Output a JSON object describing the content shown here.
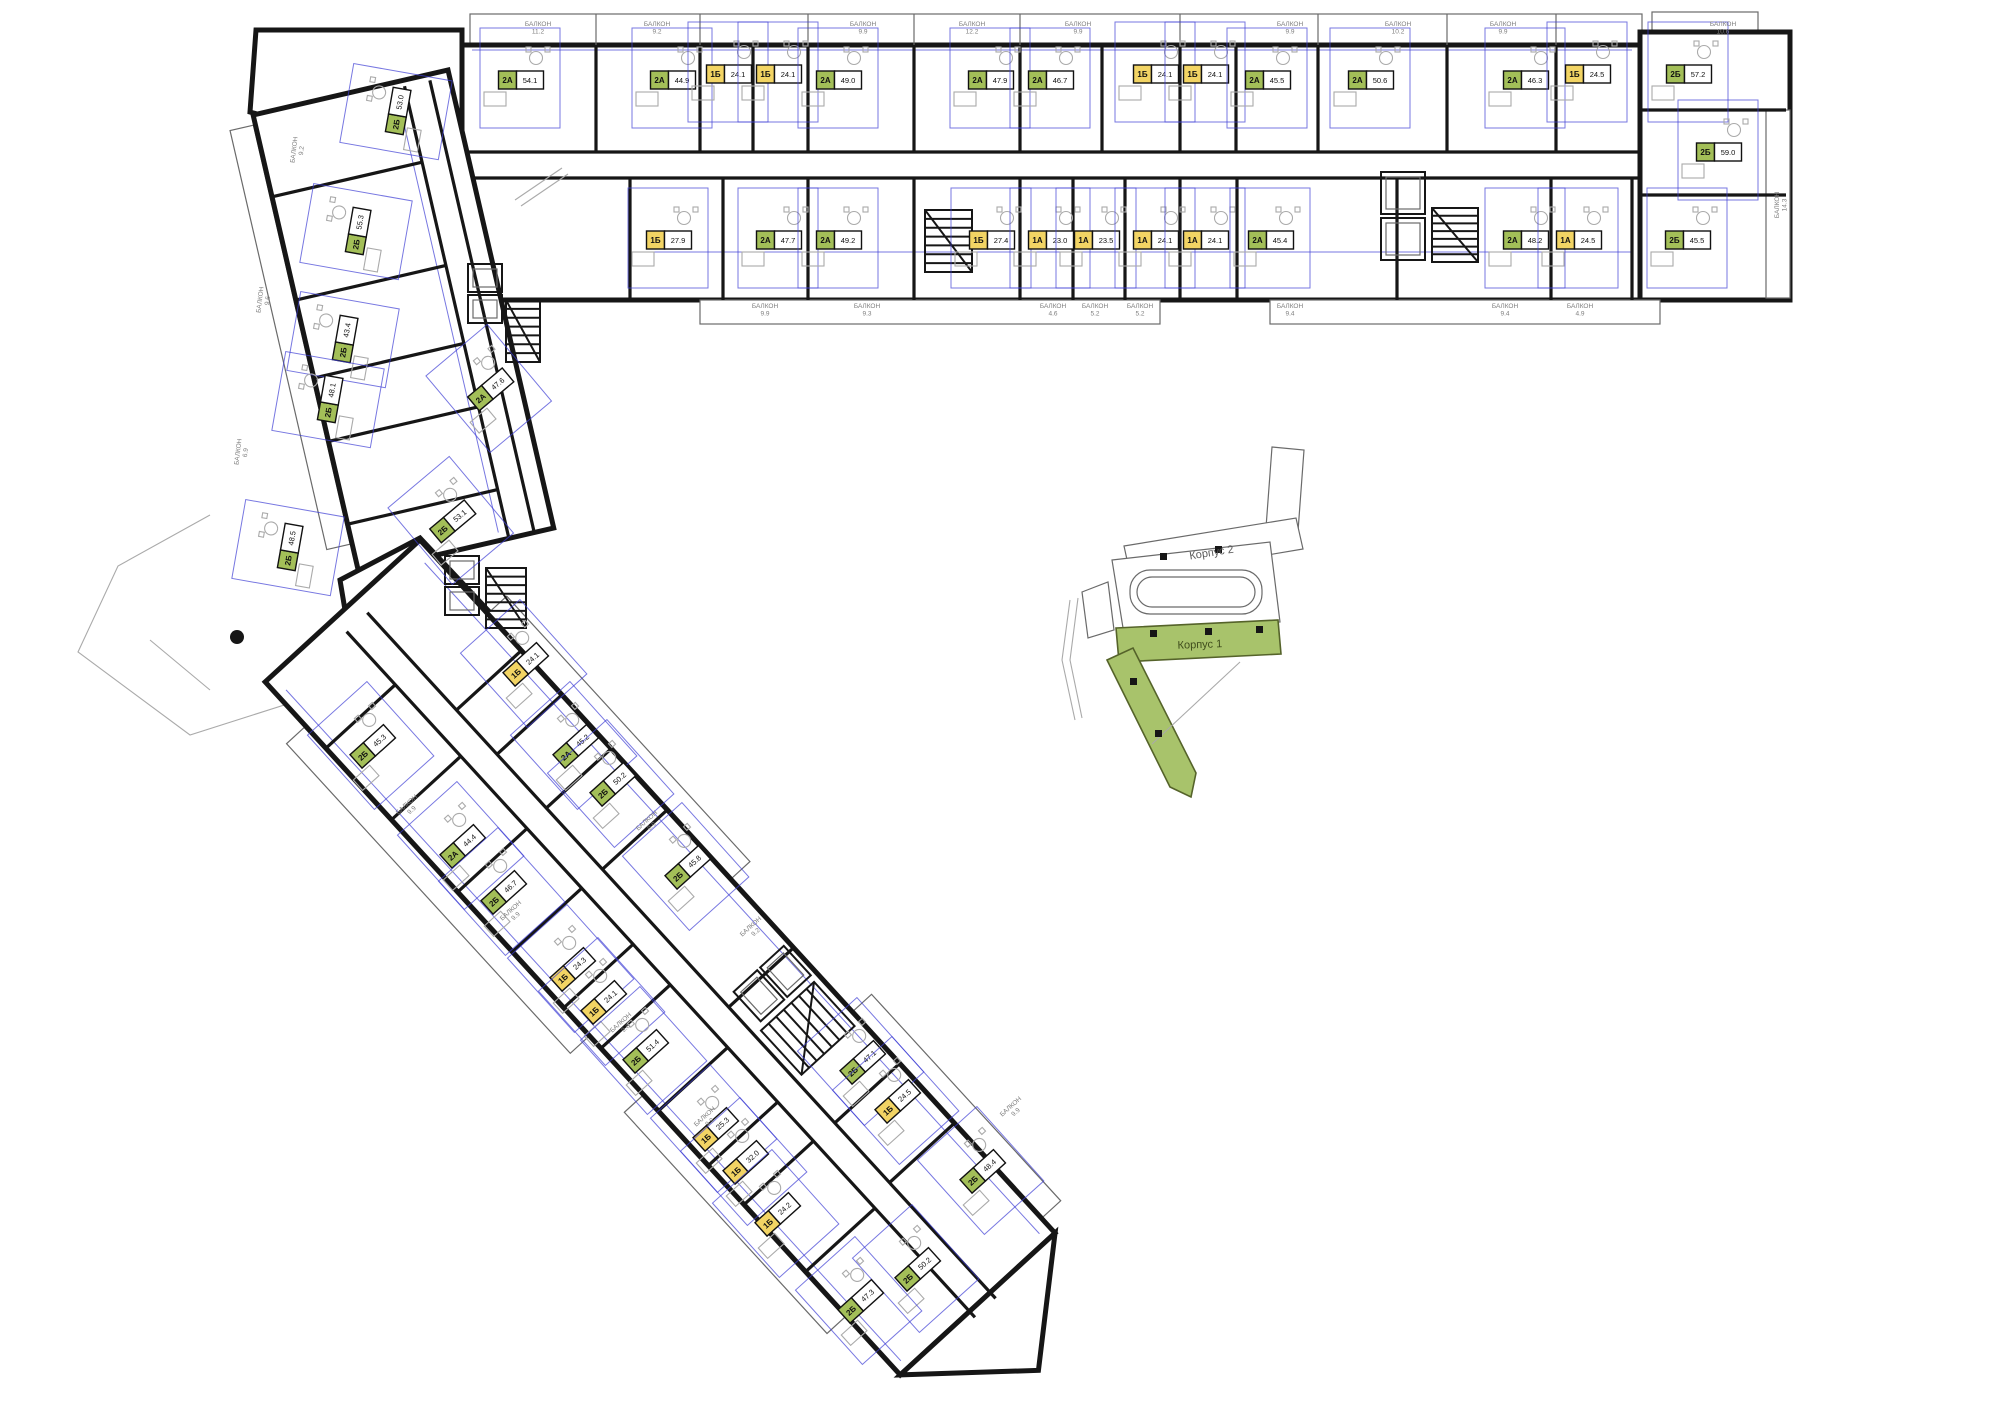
{
  "colors": {
    "wall": "#161616",
    "unit_green": "#a3bf58",
    "unit_yellow": "#f2d464",
    "keyplan_green": "#a8c36b",
    "dimension_blue": "#3d3dd4",
    "balcony_text": "#7d7d7d"
  },
  "keyplan": {
    "korpus1_label": "Корпус 1",
    "korpus2_label": "Корпус 2"
  },
  "balcony_word": "БАЛКОН",
  "units": [
    {
      "id": "u1",
      "type": "2А",
      "area": "54.1",
      "x": 520,
      "y": 80,
      "rot": 0,
      "color": "green"
    },
    {
      "id": "u2",
      "type": "2А",
      "area": "44.9",
      "x": 672,
      "y": 80,
      "rot": 0,
      "color": "green"
    },
    {
      "id": "u3",
      "type": "1Б",
      "area": "24.1",
      "x": 728,
      "y": 74,
      "rot": 0,
      "color": "yellow"
    },
    {
      "id": "u4",
      "type": "1Б",
      "area": "24.1",
      "x": 778,
      "y": 74,
      "rot": 0,
      "color": "yellow"
    },
    {
      "id": "u5",
      "type": "2А",
      "area": "49.0",
      "x": 838,
      "y": 80,
      "rot": 0,
      "color": "green"
    },
    {
      "id": "u6",
      "type": "2А",
      "area": "47.9",
      "x": 990,
      "y": 80,
      "rot": 0,
      "color": "green"
    },
    {
      "id": "u7",
      "type": "2А",
      "area": "46.7",
      "x": 1050,
      "y": 80,
      "rot": 0,
      "color": "green"
    },
    {
      "id": "u8",
      "type": "1Б",
      "area": "24.1",
      "x": 1155,
      "y": 74,
      "rot": 0,
      "color": "yellow"
    },
    {
      "id": "u9",
      "type": "1Б",
      "area": "24.1",
      "x": 1205,
      "y": 74,
      "rot": 0,
      "color": "yellow"
    },
    {
      "id": "u10",
      "type": "2А",
      "area": "45.5",
      "x": 1267,
      "y": 80,
      "rot": 0,
      "color": "green"
    },
    {
      "id": "u11",
      "type": "2А",
      "area": "50.6",
      "x": 1370,
      "y": 80,
      "rot": 0,
      "color": "green"
    },
    {
      "id": "u12",
      "type": "2А",
      "area": "46.3",
      "x": 1525,
      "y": 80,
      "rot": 0,
      "color": "green"
    },
    {
      "id": "u13",
      "type": "1Б",
      "area": "24.5",
      "x": 1587,
      "y": 74,
      "rot": 0,
      "color": "yellow"
    },
    {
      "id": "u14",
      "type": "2Б",
      "area": "57.2",
      "x": 1688,
      "y": 74,
      "rot": 0,
      "color": "green"
    },
    {
      "id": "u15",
      "type": "2Б",
      "area": "59.0",
      "x": 1718,
      "y": 152,
      "rot": 0,
      "color": "green"
    },
    {
      "id": "u16",
      "type": "1Б",
      "area": "27.9",
      "x": 668,
      "y": 240,
      "rot": 0,
      "color": "yellow"
    },
    {
      "id": "u17",
      "type": "2А",
      "area": "47.7",
      "x": 778,
      "y": 240,
      "rot": 0,
      "color": "green"
    },
    {
      "id": "u18",
      "type": "2А",
      "area": "49.2",
      "x": 838,
      "y": 240,
      "rot": 0,
      "color": "green"
    },
    {
      "id": "u19",
      "type": "1Б",
      "area": "27.4",
      "x": 991,
      "y": 240,
      "rot": 0,
      "color": "yellow"
    },
    {
      "id": "u20",
      "type": "1А",
      "area": "23.0",
      "x": 1050,
      "y": 240,
      "rot": 0,
      "color": "yellow"
    },
    {
      "id": "u21",
      "type": "1А",
      "area": "23.5",
      "x": 1096,
      "y": 240,
      "rot": 0,
      "color": "yellow"
    },
    {
      "id": "u22",
      "type": "1А",
      "area": "24.1",
      "x": 1155,
      "y": 240,
      "rot": 0,
      "color": "yellow"
    },
    {
      "id": "u23",
      "type": "1А",
      "area": "24.1",
      "x": 1205,
      "y": 240,
      "rot": 0,
      "color": "yellow"
    },
    {
      "id": "u24",
      "type": "2А",
      "area": "45.4",
      "x": 1270,
      "y": 240,
      "rot": 0,
      "color": "green"
    },
    {
      "id": "u25",
      "type": "2А",
      "area": "48.2",
      "x": 1525,
      "y": 240,
      "rot": 0,
      "color": "green"
    },
    {
      "id": "u26",
      "type": "1А",
      "area": "24.5",
      "x": 1578,
      "y": 240,
      "rot": 0,
      "color": "yellow"
    },
    {
      "id": "u27",
      "type": "2Б",
      "area": "45.5",
      "x": 1687,
      "y": 240,
      "rot": 0,
      "color": "green"
    },
    {
      "id": "u28",
      "type": "2Б",
      "area": "53.0",
      "x": 398,
      "y": 112,
      "rot": -80,
      "color": "green"
    },
    {
      "id": "u29",
      "type": "2Б",
      "area": "55.3",
      "x": 358,
      "y": 232,
      "rot": -80,
      "color": "green"
    },
    {
      "id": "u30",
      "type": "2Б",
      "area": "43.4",
      "x": 345,
      "y": 340,
      "rot": -80,
      "color": "green"
    },
    {
      "id": "u31",
      "type": "2Б",
      "area": "48.1",
      "x": 330,
      "y": 400,
      "rot": -80,
      "color": "green"
    },
    {
      "id": "u32",
      "type": "2Б",
      "area": "48.5",
      "x": 290,
      "y": 548,
      "rot": -80,
      "color": "green"
    },
    {
      "id": "u33",
      "type": "2А",
      "area": "47.6",
      "x": 490,
      "y": 390,
      "rot": -40,
      "color": "green"
    },
    {
      "id": "u34",
      "type": "2Б",
      "area": "53.1",
      "x": 452,
      "y": 522,
      "rot": -40,
      "color": "green"
    },
    {
      "id": "u35",
      "type": "1Б",
      "area": "24.1",
      "x": 525,
      "y": 665,
      "rot": -42,
      "color": "yellow"
    },
    {
      "id": "u36",
      "type": "2А",
      "area": "45.2",
      "x": 575,
      "y": 747,
      "rot": -42,
      "color": "green"
    },
    {
      "id": "u37",
      "type": "2Б",
      "area": "50.2",
      "x": 612,
      "y": 785,
      "rot": -42,
      "color": "green"
    },
    {
      "id": "u38",
      "type": "2Б",
      "area": "45.8",
      "x": 687,
      "y": 868,
      "rot": -42,
      "color": "green"
    },
    {
      "id": "u39",
      "type": "2Б",
      "area": "47.1",
      "x": 862,
      "y": 1063,
      "rot": -42,
      "color": "green"
    },
    {
      "id": "u40",
      "type": "1Б",
      "area": "24.5",
      "x": 897,
      "y": 1102,
      "rot": -42,
      "color": "yellow"
    },
    {
      "id": "u41",
      "type": "2Б",
      "area": "48.4",
      "x": 982,
      "y": 1172,
      "rot": -42,
      "color": "green"
    },
    {
      "id": "u42",
      "type": "2Б",
      "area": "45.3",
      "x": 372,
      "y": 747,
      "rot": -42,
      "color": "green"
    },
    {
      "id": "u43",
      "type": "2А",
      "area": "44.4",
      "x": 462,
      "y": 847,
      "rot": -42,
      "color": "green"
    },
    {
      "id": "u44",
      "type": "2Б",
      "area": "46.7",
      "x": 503,
      "y": 893,
      "rot": -42,
      "color": "green"
    },
    {
      "id": "u45",
      "type": "1Б",
      "area": "24.3",
      "x": 572,
      "y": 970,
      "rot": -42,
      "color": "yellow"
    },
    {
      "id": "u46",
      "type": "1Б",
      "area": "24.1",
      "x": 603,
      "y": 1003,
      "rot": -42,
      "color": "yellow"
    },
    {
      "id": "u47",
      "type": "2Б",
      "area": "51.4",
      "x": 645,
      "y": 1052,
      "rot": -42,
      "color": "green"
    },
    {
      "id": "u48",
      "type": "1Б",
      "area": "25.3",
      "x": 715,
      "y": 1130,
      "rot": -42,
      "color": "yellow"
    },
    {
      "id": "u49",
      "type": "1Б",
      "area": "32.0",
      "x": 745,
      "y": 1163,
      "rot": -42,
      "color": "yellow"
    },
    {
      "id": "u50",
      "type": "1Б",
      "area": "24.2",
      "x": 777,
      "y": 1215,
      "rot": -42,
      "color": "yellow"
    },
    {
      "id": "u51",
      "type": "2Б",
      "area": "50.2",
      "x": 917,
      "y": 1270,
      "rot": -42,
      "color": "green"
    },
    {
      "id": "u52",
      "type": "2Б",
      "area": "47.3",
      "x": 860,
      "y": 1302,
      "rot": -42,
      "color": "green"
    }
  ],
  "balconies": [
    {
      "area": "11.2",
      "x": 538,
      "y": 26,
      "rot": 0
    },
    {
      "area": "9.2",
      "x": 657,
      "y": 26,
      "rot": 0
    },
    {
      "area": "9.9",
      "x": 863,
      "y": 26,
      "rot": 0
    },
    {
      "area": "12.2",
      "x": 972,
      "y": 26,
      "rot": 0
    },
    {
      "area": "9.9",
      "x": 1078,
      "y": 26,
      "rot": 0
    },
    {
      "area": "9.9",
      "x": 1290,
      "y": 26,
      "rot": 0
    },
    {
      "area": "10.2",
      "x": 1398,
      "y": 26,
      "rot": 0
    },
    {
      "area": "9.9",
      "x": 1503,
      "y": 26,
      "rot": 0
    },
    {
      "area": "10.6",
      "x": 1723,
      "y": 26,
      "rot": 0
    },
    {
      "area": "9.9",
      "x": 765,
      "y": 308,
      "rot": 0
    },
    {
      "area": "9.3",
      "x": 867,
      "y": 308,
      "rot": 0
    },
    {
      "area": "4.6",
      "x": 1053,
      "y": 308,
      "rot": 0
    },
    {
      "area": "5.2",
      "x": 1095,
      "y": 308,
      "rot": 0
    },
    {
      "area": "5.2",
      "x": 1140,
      "y": 308,
      "rot": 0
    },
    {
      "area": "9.4",
      "x": 1290,
      "y": 308,
      "rot": 0
    },
    {
      "area": "9.4",
      "x": 1505,
      "y": 308,
      "rot": 0
    },
    {
      "area": "4.9",
      "x": 1580,
      "y": 308,
      "rot": 0
    },
    {
      "area": "14.3",
      "x": 1779,
      "y": 205,
      "rot": -90
    },
    {
      "area": "9.2",
      "x": 296,
      "y": 150,
      "rot": -83
    },
    {
      "area": "9.6",
      "x": 262,
      "y": 300,
      "rot": -83
    },
    {
      "area": "6.9",
      "x": 240,
      "y": 452,
      "rot": -83
    },
    {
      "area": "9.9",
      "x": 408,
      "y": 806,
      "rot": -42
    },
    {
      "area": "9.9",
      "x": 512,
      "y": 912,
      "rot": -42
    },
    {
      "area": "9.6",
      "x": 622,
      "y": 1024,
      "rot": -42
    },
    {
      "area": "9.9",
      "x": 706,
      "y": 1118,
      "rot": -42
    },
    {
      "area": "9.9",
      "x": 648,
      "y": 822,
      "rot": -42
    },
    {
      "area": "9.2",
      "x": 752,
      "y": 928,
      "rot": -42
    },
    {
      "area": "9.9",
      "x": 1012,
      "y": 1108,
      "rot": -42
    }
  ]
}
